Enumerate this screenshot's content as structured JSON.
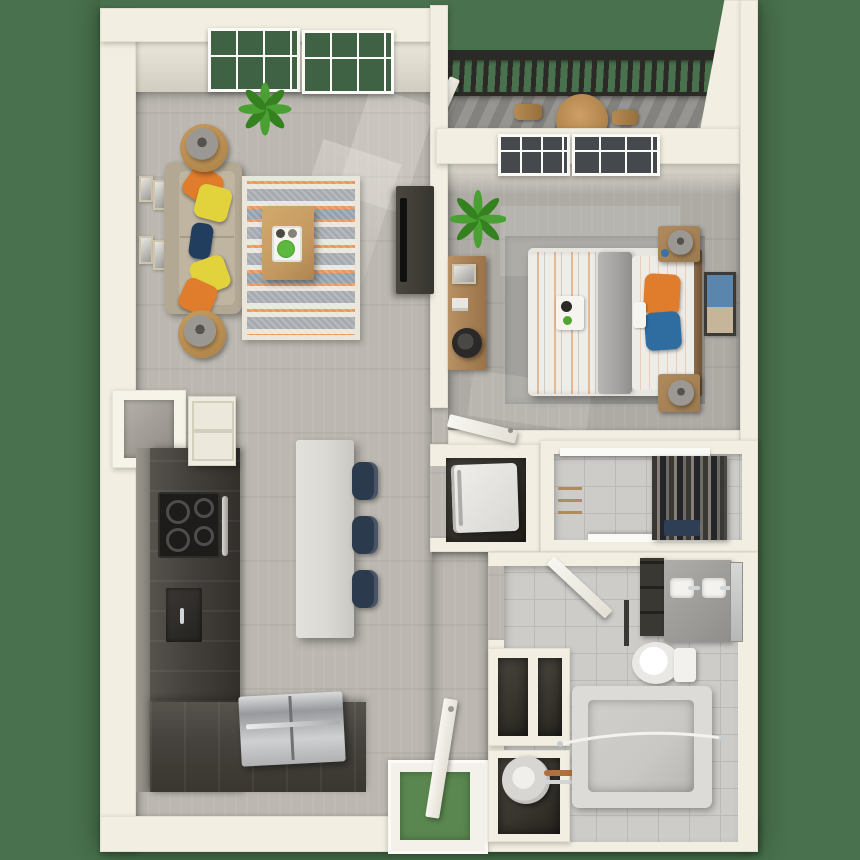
{
  "scene": {
    "type": "3d-floor-plan-render",
    "rooms": [
      {
        "name": "living-room",
        "furniture": [
          "sofa",
          "throw-pillows",
          "area-rug",
          "coffee-table",
          "side-tables-with-lamps",
          "wall-art",
          "potted-plant",
          "tv-console",
          "windows"
        ]
      },
      {
        "name": "kitchen",
        "furniture": [
          "l-shaped-counter",
          "cooktop",
          "upper-cabinet",
          "pass-through-nook",
          "island",
          "bar-stools",
          "refrigerator"
        ]
      },
      {
        "name": "bedroom",
        "furniture": [
          "bed",
          "nightstands-with-lamps",
          "desk-with-chair",
          "potted-plant",
          "wall-art",
          "windows",
          "door"
        ]
      },
      {
        "name": "balcony",
        "furniture": [
          "railing",
          "round-table",
          "chairs",
          "plank-floor"
        ]
      },
      {
        "name": "laundry-closet",
        "furniture": [
          "washer-dryer"
        ]
      },
      {
        "name": "walk-in-closet",
        "furniture": [
          "hanging-clothes",
          "shelves",
          "hangers"
        ]
      },
      {
        "name": "bathroom",
        "furniture": [
          "vanity-double-sink",
          "mirror",
          "toilet",
          "bathtub",
          "shower-rod",
          "water-heater",
          "storage-niches",
          "door"
        ]
      },
      {
        "name": "entry",
        "furniture": [
          "front-door",
          "threshold-mat"
        ]
      }
    ]
  },
  "palette": {
    "outdoor": "#49714d",
    "mat_green": "#5a874f",
    "wall": "#f2eee1",
    "wall_face": "#e6e1d4",
    "wood": "#bcb8b1",
    "wood_shade": "#a9a59f",
    "bed_floor": "#aeaba5",
    "tile": "#cdccc9",
    "grout": "#bbbab7",
    "charcoal": "#45423d",
    "charcoal_dark": "#322f2b",
    "cooktop": "#1d1c1a",
    "island": "#dbd9d4",
    "navy": "#2c3a4e",
    "sofa": "#b2a894",
    "cushion": "#bfb5a1",
    "orange": "#e07d2c",
    "yellow": "#e2d23c",
    "lumbar_navy": "#223e5f",
    "rug_cream": "#eae6dc",
    "rug_gray": "#a7abb0",
    "rug_slate": "#97a1ac",
    "rug_orange": "#e9995f",
    "wood_table": "#c59a62",
    "wood_night": "#9c7a50",
    "tv": "#37352f",
    "plant": "#4aa033",
    "plant_dark": "#35801f",
    "white": "#f6f4ee",
    "stain_a": "#cfd0d2",
    "stain_b": "#97999c",
    "lamp": "#9b9894",
    "blanket": "#a5a4a2",
    "blue": "#2f6da1",
    "balc_a": "#979591",
    "balc_b": "#84827e",
    "railing": "#2b2a27",
    "dark_room": "#39362f",
    "tub": "#c9c8c4",
    "tub_rim": "#dcdbd7",
    "copper": "#b06f3c",
    "chrome": "#d3d6d8",
    "pane_green": "#3e6243",
    "pane_dark": "#45494d",
    "door_white": "#f8f6f1"
  }
}
